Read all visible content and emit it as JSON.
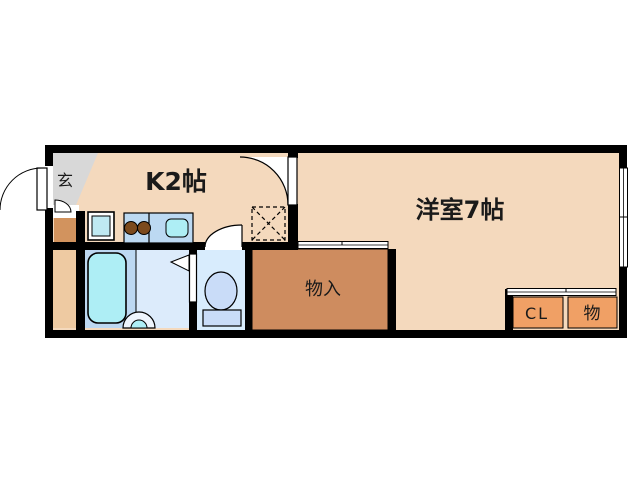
{
  "floorplan": {
    "rooms": {
      "genkan": {
        "label": "玄"
      },
      "kitchen": {
        "label": "K2帖"
      },
      "western_room": {
        "label": "洋室7帖"
      },
      "storage": {
        "label": "物入"
      },
      "closet": {
        "label": "CL"
      },
      "storage_small": {
        "label": "物"
      }
    },
    "colors": {
      "wall": "#000000",
      "floor_main": "#f4d9bd",
      "genkan_gray": "#d8d8d8",
      "hall_dark": "#d2935e",
      "hall_light": "#eecaa2",
      "bath_floor": "#bdd8f1",
      "wash_floor": "#dcebfb",
      "toilet_floor": "#d8ecfd",
      "fixture_blue": "#c9dcf8",
      "tub_cyan": "#aeeef5",
      "counter_blue": "#bcd9f2",
      "washer_blue": "#bfe9f2",
      "storage_brown": "#ce8c5f",
      "closet_orange": "#f0a065",
      "burner_brown": "#7c4a1d",
      "basin_outer": "#eef5fd",
      "door_white": "#ffffff"
    }
  }
}
